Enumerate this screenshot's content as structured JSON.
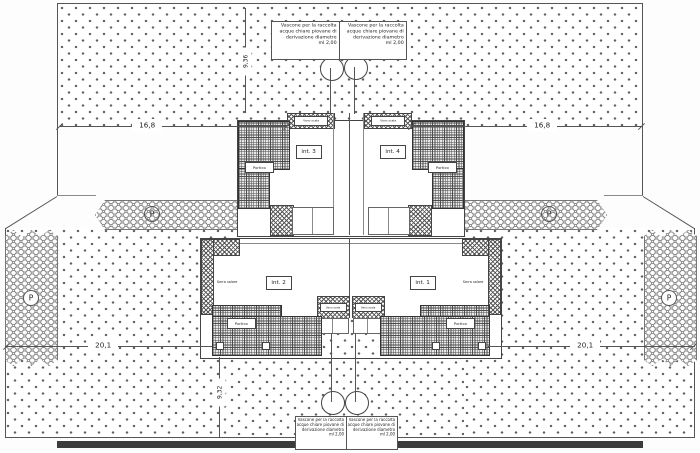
{
  "plan": {
    "parking_label": "P",
    "units": {
      "int1": "int. 1",
      "int2": "int. 2",
      "int3": "int. 3",
      "int4": "int. 4"
    },
    "rooms": {
      "portico": "Portico",
      "serra_solare": "Serra solare",
      "vano_scala": "Vano scala"
    },
    "dims": {
      "top_left": "16,8",
      "top_right": "16,8",
      "bottom_left": "20,1",
      "bottom_right": "20,1",
      "vert_top": "9,36",
      "vert_bottom": "9,32"
    },
    "annotations": {
      "top_left": [
        "Vascone per la raccolta",
        "acque chiare piovane di",
        "derivazione diametro",
        "ml 2,00"
      ],
      "top_right": [
        "Vascone per la raccolta",
        "acque chiare piovane di",
        "derivazione diametro",
        "ml 2,00"
      ],
      "bottom_left": [
        "Vascone per la raccolta",
        "acque chiare piovane di",
        "derivazione diametro",
        "ml 2,00"
      ],
      "bottom_right": [
        "Vascone per la raccolta",
        "acque chiare piovane di",
        "derivazione diametro",
        "ml 2,00"
      ]
    }
  }
}
